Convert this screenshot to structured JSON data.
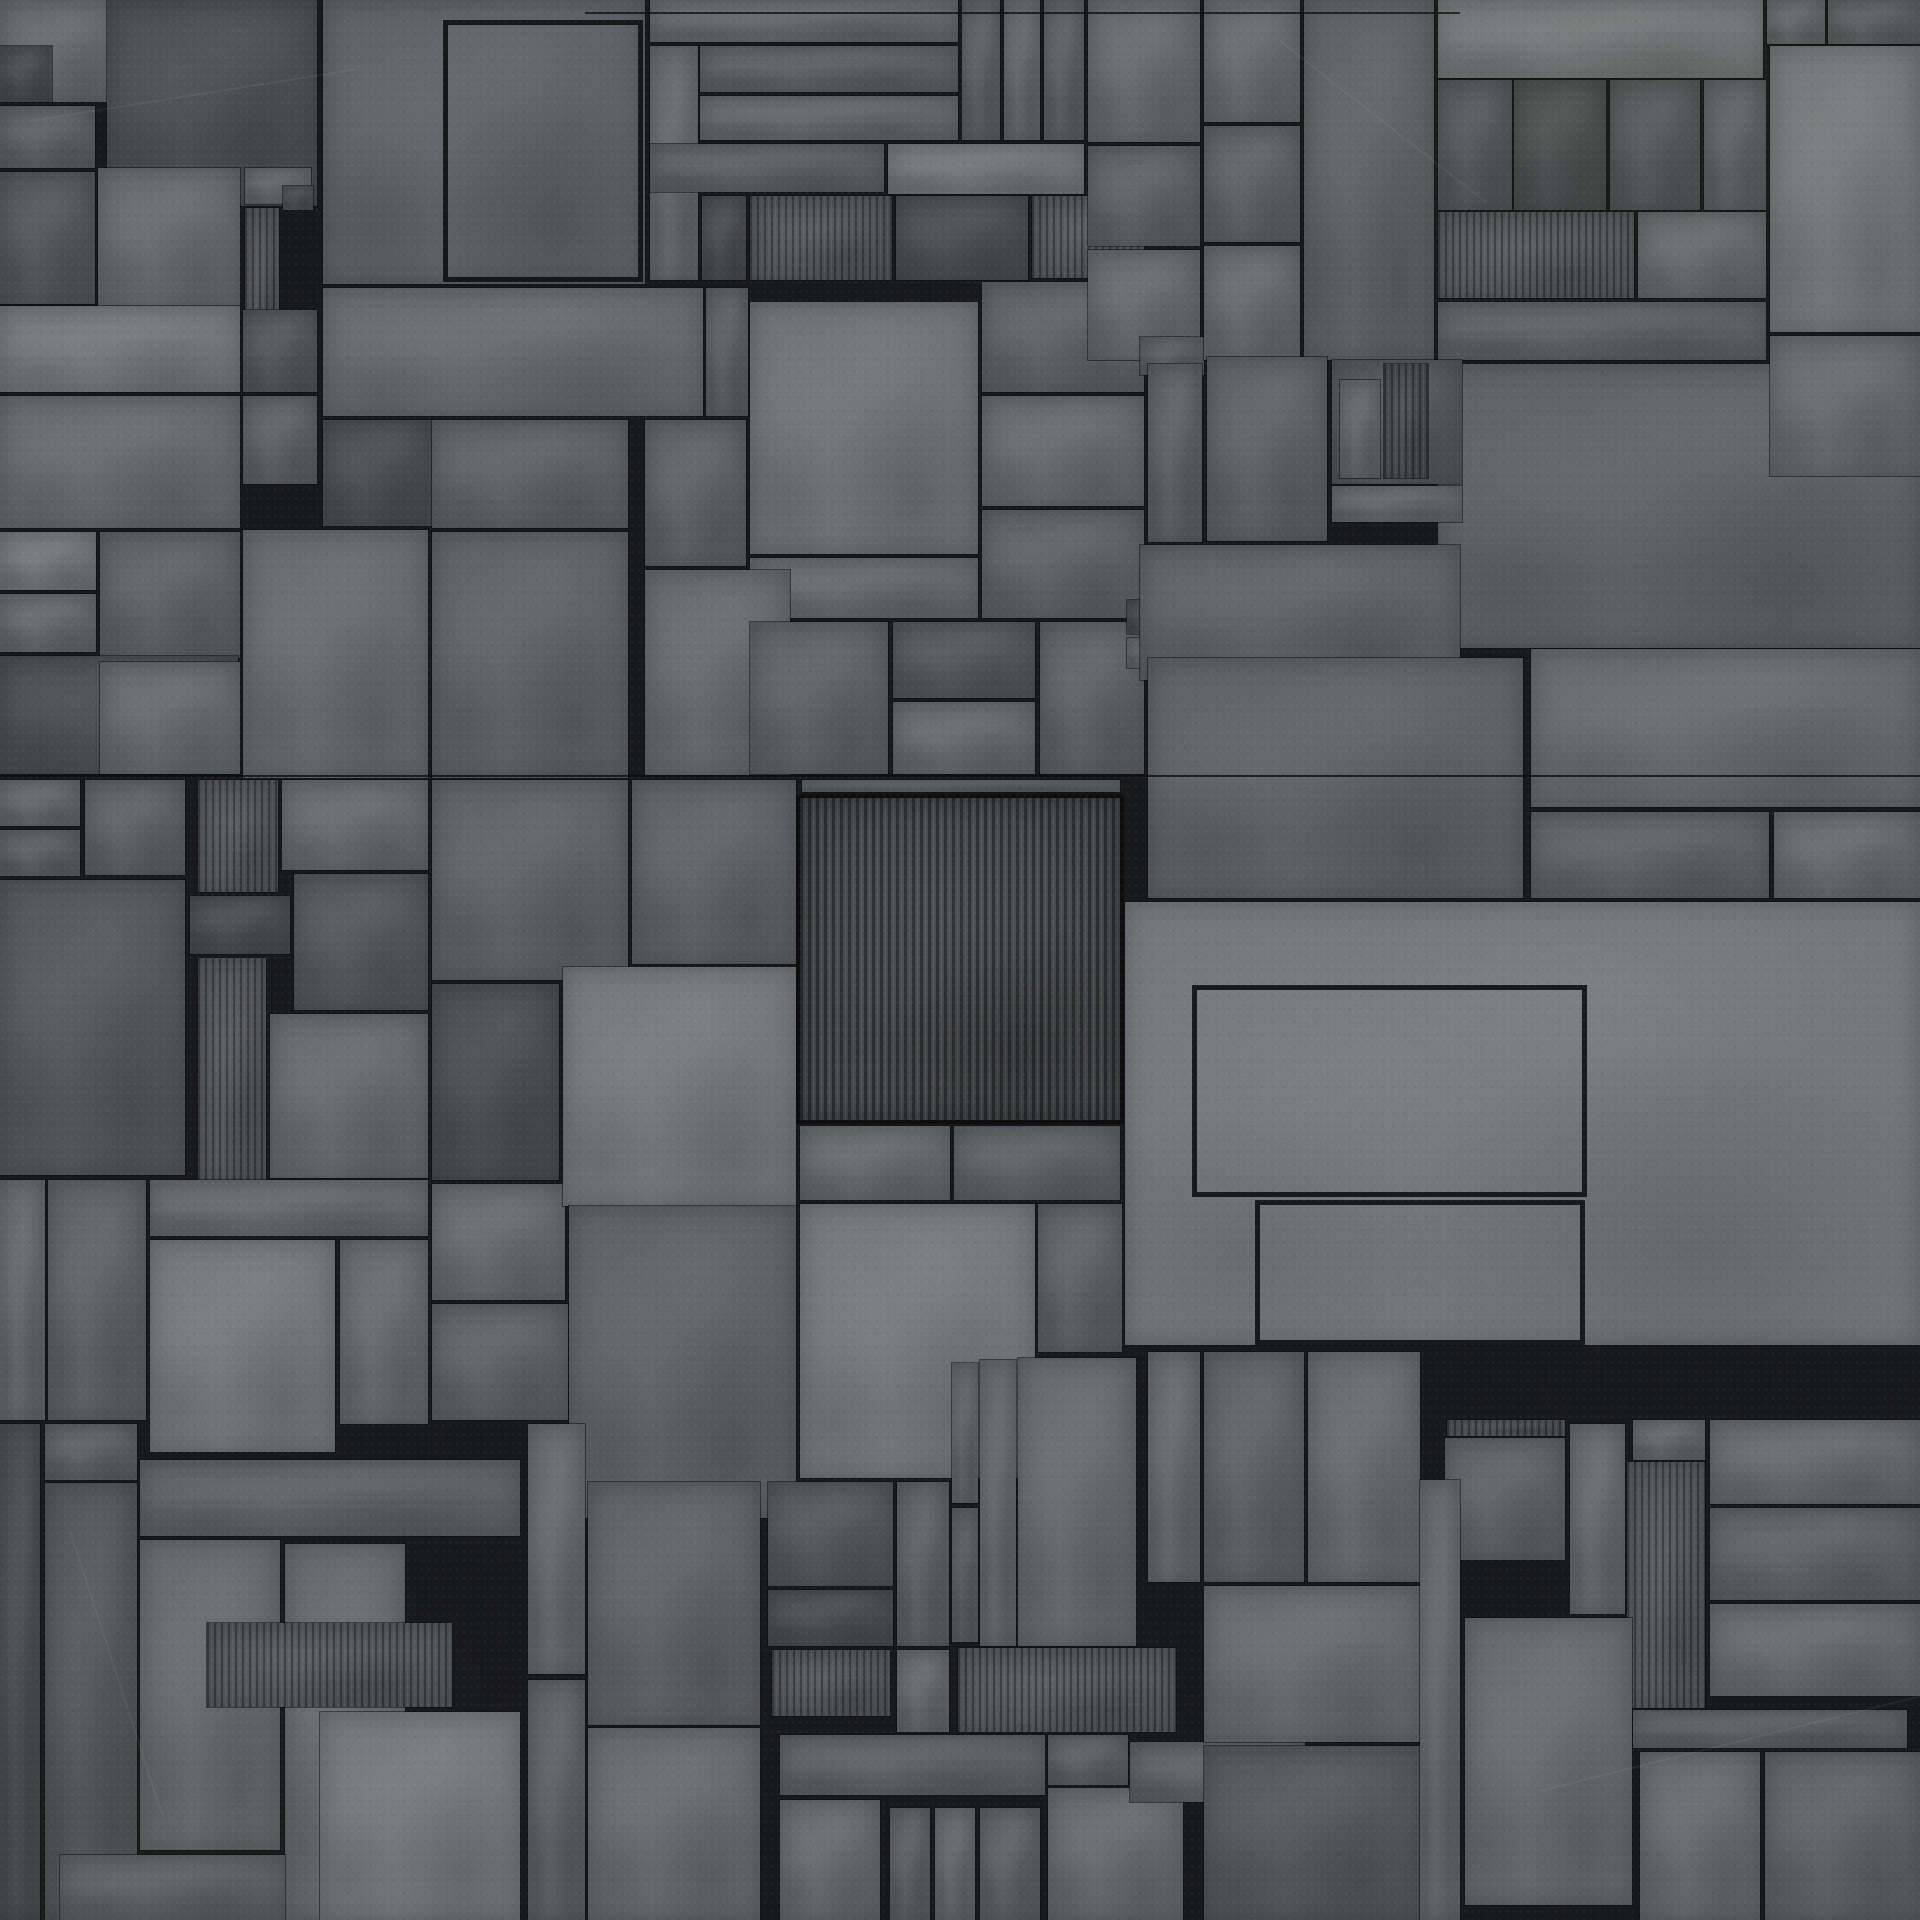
{
  "canvas": {
    "width": 1920,
    "height": 1920
  },
  "texture_description": "sci-fi greeble plating: overlapping rectangular concrete-metal panels in gray tones separated by black grout lines; some panels vertically corrugated",
  "palette": {
    "grout_line": "#17181a",
    "tone_d1": "#4b4d50",
    "tone_d2": "#54565a",
    "tone_m1": "#5e6165",
    "tone_m2": "#666a6d",
    "tone_l1": "#75787b",
    "tone_l2": "#6f7276",
    "stripe_groove": "rgba(0,0,0,0.35)",
    "stripe_highlight": "rgba(255,255,255,0.06)"
  },
  "stripe_pitch_px": {
    "fine": 7,
    "central": 8
  },
  "panel_fields": "x, y, w, h, tone(d1|d2|m1|m2|l1|l2), stripe(0=none|1=fine ribs|2=central ribs), frame(0=solid|1=outline only)",
  "panels": [
    [
      0,
      0,
      118,
      102,
      "m2",
      0,
      0
    ],
    [
      0,
      46,
      52,
      56,
      "d1",
      0,
      0
    ],
    [
      0,
      106,
      95,
      62,
      "m1",
      0,
      0
    ],
    [
      0,
      172,
      95,
      132,
      "d2",
      0,
      0
    ],
    [
      107,
      0,
      210,
      206,
      "d1",
      0,
      0
    ],
    [
      323,
      0,
      322,
      284,
      "m1",
      0,
      0
    ],
    [
      443,
      20,
      200,
      262,
      "m1",
      0,
      1
    ],
    [
      98,
      168,
      142,
      140,
      "m2",
      0,
      0
    ],
    [
      245,
      168,
      66,
      36,
      "m2",
      0,
      0
    ],
    [
      245,
      208,
      34,
      148,
      "d2",
      1,
      0
    ],
    [
      283,
      186,
      30,
      24,
      "d2",
      0,
      0
    ],
    [
      0,
      306,
      240,
      86,
      "l1",
      0,
      0
    ],
    [
      0,
      396,
      240,
      132,
      "m2",
      0,
      0
    ],
    [
      243,
      310,
      74,
      82,
      "d2",
      0,
      0
    ],
    [
      243,
      396,
      74,
      88,
      "m1",
      0,
      0
    ],
    [
      323,
      288,
      380,
      128,
      "m2",
      0,
      0
    ],
    [
      323,
      420,
      109,
      106,
      "d1",
      0,
      0
    ],
    [
      432,
      420,
      196,
      108,
      "m1",
      0,
      0
    ],
    [
      0,
      532,
      96,
      58,
      "l1",
      0,
      0
    ],
    [
      0,
      594,
      96,
      58,
      "m2",
      0,
      0
    ],
    [
      100,
      532,
      140,
      126,
      "m1",
      0,
      0
    ],
    [
      0,
      656,
      238,
      118,
      "d1",
      0,
      0
    ],
    [
      100,
      662,
      140,
      112,
      "m2",
      0,
      0
    ],
    [
      243,
      530,
      185,
      248,
      "m2",
      0,
      0
    ],
    [
      432,
      532,
      196,
      246,
      "m1",
      0,
      0
    ],
    [
      650,
      0,
      308,
      42,
      "m2",
      0,
      0
    ],
    [
      700,
      46,
      258,
      46,
      "m1",
      0,
      0
    ],
    [
      700,
      96,
      258,
      44,
      "m2",
      0,
      0
    ],
    [
      650,
      46,
      48,
      234,
      "m2",
      0,
      0
    ],
    [
      650,
      144,
      234,
      48,
      "m1",
      0,
      0
    ],
    [
      962,
      0,
      38,
      140,
      "m1",
      0,
      0
    ],
    [
      1004,
      0,
      36,
      140,
      "m2",
      0,
      0
    ],
    [
      1044,
      0,
      40,
      140,
      "m1",
      0,
      0
    ],
    [
      888,
      144,
      196,
      50,
      "l1",
      0,
      0
    ],
    [
      702,
      196,
      44,
      84,
      "d1",
      0,
      0
    ],
    [
      750,
      196,
      142,
      84,
      "d2",
      1,
      0
    ],
    [
      896,
      196,
      132,
      84,
      "d1",
      0,
      0
    ],
    [
      1032,
      196,
      112,
      82,
      "d2",
      1,
      0
    ],
    [
      706,
      288,
      42,
      128,
      "m1",
      0,
      0
    ],
    [
      750,
      302,
      228,
      252,
      "l2",
      0,
      0
    ],
    [
      982,
      282,
      162,
      110,
      "m1",
      0,
      0
    ],
    [
      982,
      396,
      162,
      110,
      "m2",
      0,
      0
    ],
    [
      982,
      510,
      162,
      108,
      "m1",
      0,
      0
    ],
    [
      645,
      420,
      101,
      146,
      "m1",
      0,
      0
    ],
    [
      750,
      558,
      228,
      60,
      "m2",
      0,
      0
    ],
    [
      645,
      570,
      145,
      205,
      "m2",
      0,
      0
    ],
    [
      750,
      622,
      138,
      152,
      "m1",
      0,
      0
    ],
    [
      893,
      622,
      142,
      76,
      "d2",
      0,
      0
    ],
    [
      893,
      702,
      142,
      72,
      "m2",
      0,
      0
    ],
    [
      1040,
      622,
      104,
      152,
      "m1",
      0,
      0
    ],
    [
      1127,
      600,
      34,
      34,
      "d1",
      0,
      0
    ],
    [
      1127,
      638,
      34,
      30,
      "m2",
      0,
      0
    ],
    [
      1088,
      0,
      112,
      142,
      "m2",
      0,
      0
    ],
    [
      1088,
      146,
      112,
      100,
      "m1",
      0,
      0
    ],
    [
      1088,
      250,
      112,
      110,
      "m2",
      0,
      0
    ],
    [
      1204,
      0,
      96,
      122,
      "m2",
      0,
      0
    ],
    [
      1204,
      126,
      96,
      116,
      "m1",
      0,
      0
    ],
    [
      1304,
      0,
      130,
      360,
      "m1",
      0,
      0
    ],
    [
      1438,
      0,
      325,
      78,
      "l1",
      0,
      0
    ],
    [
      1767,
      0,
      58,
      44,
      "m2",
      0,
      0
    ],
    [
      1828,
      0,
      92,
      44,
      "m1",
      0,
      0
    ],
    [
      1770,
      46,
      150,
      286,
      "l1",
      0,
      0
    ],
    [
      1438,
      80,
      74,
      130,
      "d2",
      0,
      0
    ],
    [
      1514,
      80,
      92,
      130,
      "d1",
      0,
      0
    ],
    [
      1610,
      80,
      90,
      130,
      "d2",
      0,
      0
    ],
    [
      1704,
      80,
      62,
      130,
      "m1",
      0,
      0
    ],
    [
      1438,
      212,
      196,
      86,
      "d2",
      1,
      0
    ],
    [
      1638,
      212,
      128,
      86,
      "m2",
      0,
      0
    ],
    [
      1438,
      302,
      328,
      58,
      "m1",
      0,
      0
    ],
    [
      1438,
      364,
      482,
      284,
      "m1",
      0,
      0
    ],
    [
      1770,
      336,
      150,
      140,
      "m2",
      0,
      0
    ],
    [
      1140,
      337,
      64,
      38,
      "m1",
      0,
      0
    ],
    [
      1204,
      246,
      96,
      114,
      "m2",
      0,
      0
    ],
    [
      1148,
      364,
      54,
      178,
      "m1",
      0,
      0
    ],
    [
      1207,
      357,
      120,
      184,
      "m1",
      0,
      0
    ],
    [
      1332,
      360,
      130,
      124,
      "d2",
      0,
      0
    ],
    [
      1384,
      364,
      44,
      114,
      "d1",
      1,
      0
    ],
    [
      1340,
      380,
      40,
      98,
      "m2",
      0,
      0
    ],
    [
      1332,
      486,
      130,
      36,
      "m2",
      0,
      0
    ],
    [
      1140,
      545,
      320,
      135,
      "m1",
      0,
      0
    ],
    [
      0,
      780,
      80,
      46,
      "m2",
      0,
      0
    ],
    [
      0,
      830,
      80,
      46,
      "m1",
      0,
      0
    ],
    [
      0,
      880,
      185,
      295,
      "d2",
      0,
      0
    ],
    [
      85,
      780,
      100,
      95,
      "m1",
      0,
      0
    ],
    [
      198,
      780,
      80,
      112,
      "d2",
      1,
      0
    ],
    [
      282,
      780,
      146,
      90,
      "m2",
      0,
      0
    ],
    [
      190,
      896,
      100,
      58,
      "d1",
      0,
      0
    ],
    [
      294,
      874,
      134,
      136,
      "d2",
      0,
      0
    ],
    [
      198,
      958,
      68,
      222,
      "d2",
      1,
      0
    ],
    [
      270,
      1014,
      158,
      164,
      "m2",
      0,
      0
    ],
    [
      432,
      780,
      196,
      200,
      "m1",
      0,
      0
    ],
    [
      432,
      984,
      127,
      196,
      "d1",
      0,
      0
    ],
    [
      432,
      1184,
      133,
      116,
      "m2",
      0,
      0
    ],
    [
      632,
      780,
      164,
      184,
      "m1",
      0,
      0
    ],
    [
      802,
      780,
      318,
      12,
      "m2",
      0,
      0
    ],
    [
      800,
      798,
      320,
      322,
      "d1",
      2,
      0
    ],
    [
      563,
      967,
      233,
      239,
      "l1",
      0,
      0
    ],
    [
      1148,
      658,
      375,
      240,
      "m1",
      0,
      0
    ],
    [
      1531,
      649,
      389,
      158,
      "m2",
      0,
      0
    ],
    [
      1531,
      812,
      238,
      86,
      "m1",
      0,
      0
    ],
    [
      1774,
      812,
      146,
      86,
      "m2",
      0,
      0
    ],
    [
      1125,
      902,
      795,
      443,
      "l1",
      0,
      0
    ],
    [
      1192,
      985,
      395,
      212,
      "l1",
      0,
      1
    ],
    [
      1255,
      1200,
      330,
      145,
      "l1",
      0,
      1
    ],
    [
      0,
      1180,
      45,
      240,
      "m2",
      0,
      0
    ],
    [
      48,
      1180,
      98,
      240,
      "m1",
      0,
      0
    ],
    [
      150,
      1180,
      278,
      56,
      "m2",
      0,
      0
    ],
    [
      150,
      1240,
      185,
      212,
      "l1",
      0,
      0
    ],
    [
      340,
      1240,
      88,
      184,
      "m2",
      0,
      0
    ],
    [
      432,
      1304,
      136,
      116,
      "m1",
      0,
      0
    ],
    [
      569,
      1206,
      227,
      312,
      "m1",
      0,
      0
    ],
    [
      0,
      1424,
      40,
      496,
      "d1",
      0,
      0
    ],
    [
      45,
      1424,
      92,
      56,
      "m1",
      0,
      0
    ],
    [
      45,
      1483,
      92,
      437,
      "d2",
      0,
      0
    ],
    [
      140,
      1460,
      380,
      76,
      "m1",
      0,
      0
    ],
    [
      140,
      1540,
      140,
      310,
      "m2",
      0,
      0
    ],
    [
      285,
      1544,
      120,
      376,
      "m2",
      0,
      0
    ],
    [
      207,
      1623,
      245,
      84,
      "d2",
      1,
      0
    ],
    [
      320,
      1712,
      200,
      208,
      "l1",
      0,
      0
    ],
    [
      60,
      1855,
      225,
      65,
      "m1",
      0,
      0
    ],
    [
      528,
      1424,
      57,
      250,
      "m2",
      0,
      0
    ],
    [
      528,
      1680,
      57,
      240,
      "m1",
      0,
      0
    ],
    [
      800,
      1126,
      150,
      74,
      "m2",
      0,
      0
    ],
    [
      954,
      1126,
      166,
      74,
      "m1",
      0,
      0
    ],
    [
      800,
      1204,
      235,
      274,
      "l1",
      0,
      0
    ],
    [
      1038,
      1204,
      84,
      148,
      "m1",
      0,
      0
    ],
    [
      588,
      1482,
      172,
      243,
      "m1",
      0,
      0
    ],
    [
      588,
      1728,
      172,
      192,
      "m2",
      0,
      0
    ],
    [
      768,
      1482,
      125,
      104,
      "d2",
      0,
      0
    ],
    [
      768,
      1590,
      125,
      56,
      "d1",
      0,
      0
    ],
    [
      772,
      1650,
      118,
      66,
      "d2",
      1,
      0
    ],
    [
      897,
      1482,
      52,
      164,
      "m1",
      0,
      0
    ],
    [
      897,
      1650,
      52,
      82,
      "m2",
      0,
      0
    ],
    [
      952,
      1363,
      26,
      140,
      "m2",
      0,
      0
    ],
    [
      952,
      1508,
      26,
      134,
      "m1",
      0,
      0
    ],
    [
      980,
      1360,
      36,
      286,
      "m2",
      0,
      0
    ],
    [
      1018,
      1358,
      118,
      288,
      "m2",
      0,
      0
    ],
    [
      1148,
      1352,
      52,
      230,
      "m2",
      0,
      0
    ],
    [
      958,
      1648,
      218,
      84,
      "d2",
      1,
      0
    ],
    [
      780,
      1735,
      265,
      60,
      "m1",
      0,
      0
    ],
    [
      780,
      1800,
      100,
      120,
      "m2",
      0,
      0
    ],
    [
      890,
      1808,
      40,
      112,
      "m1",
      0,
      0
    ],
    [
      935,
      1808,
      40,
      112,
      "m2",
      0,
      0
    ],
    [
      980,
      1808,
      60,
      112,
      "m1",
      0,
      0
    ],
    [
      1048,
      1735,
      80,
      50,
      "m1",
      0,
      0
    ],
    [
      1048,
      1788,
      135,
      132,
      "m2",
      0,
      0
    ],
    [
      1130,
      1742,
      175,
      60,
      "m1",
      0,
      0
    ],
    [
      1204,
      1352,
      100,
      230,
      "m1",
      0,
      0
    ],
    [
      1308,
      1352,
      112,
      230,
      "m2",
      0,
      0
    ],
    [
      1204,
      1586,
      216,
      156,
      "m2",
      0,
      0
    ],
    [
      1204,
      1746,
      216,
      174,
      "d2",
      0,
      0
    ],
    [
      1447,
      1420,
      118,
      16,
      "d2",
      1,
      0
    ],
    [
      1445,
      1438,
      120,
      122,
      "m1",
      0,
      0
    ],
    [
      1420,
      1480,
      40,
      440,
      "m2",
      0,
      0
    ],
    [
      1570,
      1424,
      55,
      190,
      "m2",
      0,
      0
    ],
    [
      1633,
      1420,
      72,
      40,
      "m2",
      0,
      0
    ],
    [
      1627,
      1462,
      78,
      246,
      "d2",
      1,
      0
    ],
    [
      1465,
      1618,
      167,
      287,
      "m2",
      0,
      0
    ],
    [
      1710,
      1420,
      210,
      84,
      "m2",
      0,
      0
    ],
    [
      1710,
      1508,
      210,
      92,
      "m1",
      0,
      0
    ],
    [
      1710,
      1604,
      210,
      92,
      "m2",
      0,
      0
    ],
    [
      1633,
      1710,
      274,
      38,
      "m1",
      0,
      0
    ],
    [
      1640,
      1752,
      120,
      168,
      "m2",
      0,
      0
    ],
    [
      1765,
      1752,
      155,
      168,
      "m1",
      0,
      0
    ]
  ],
  "seams": [
    {
      "x": 0,
      "y": 775,
      "w": 1920
    },
    {
      "x": 585,
      "y": 12,
      "w": 875
    }
  ],
  "scratches": [
    {
      "x": 30,
      "y": 120,
      "w": 330,
      "angle": -9
    },
    {
      "x": 1280,
      "y": 40,
      "w": 260,
      "angle": 38
    },
    {
      "x": 1540,
      "y": 1790,
      "w": 420,
      "angle": -14
    },
    {
      "x": 70,
      "y": 1530,
      "w": 300,
      "angle": 72
    }
  ]
}
